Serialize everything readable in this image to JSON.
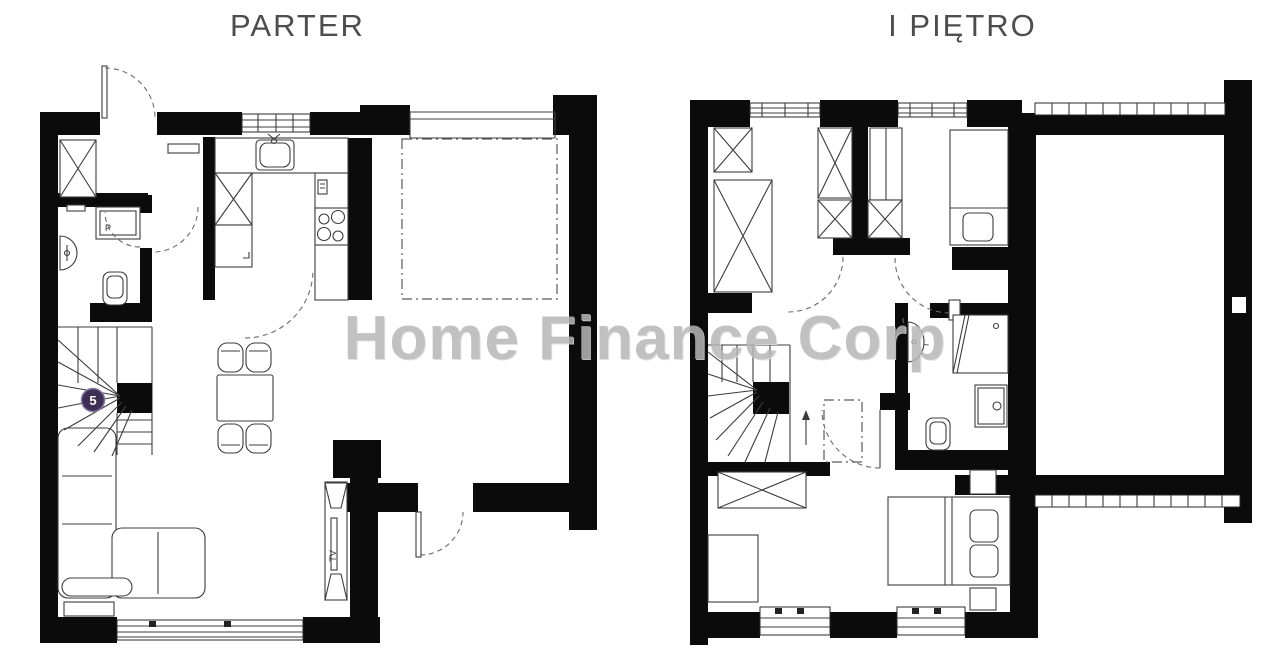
{
  "page": {
    "background": "#ffffff"
  },
  "plans": {
    "left": {
      "title": "PARTER"
    },
    "right": {
      "title": "I PIĘTRO"
    }
  },
  "watermark": {
    "text": "Home Finance Corp",
    "color": "#b7b7b7"
  },
  "stairs_badge": {
    "value": "5",
    "bg": "#3e3054",
    "fg": "#ffffff"
  },
  "labels": {
    "tv": "TV",
    "shower": "P"
  },
  "colors": {
    "wall": "#0b0b0b",
    "line": "#3c3c3c",
    "dashed": "#666666",
    "title": "#4d4d4d"
  }
}
